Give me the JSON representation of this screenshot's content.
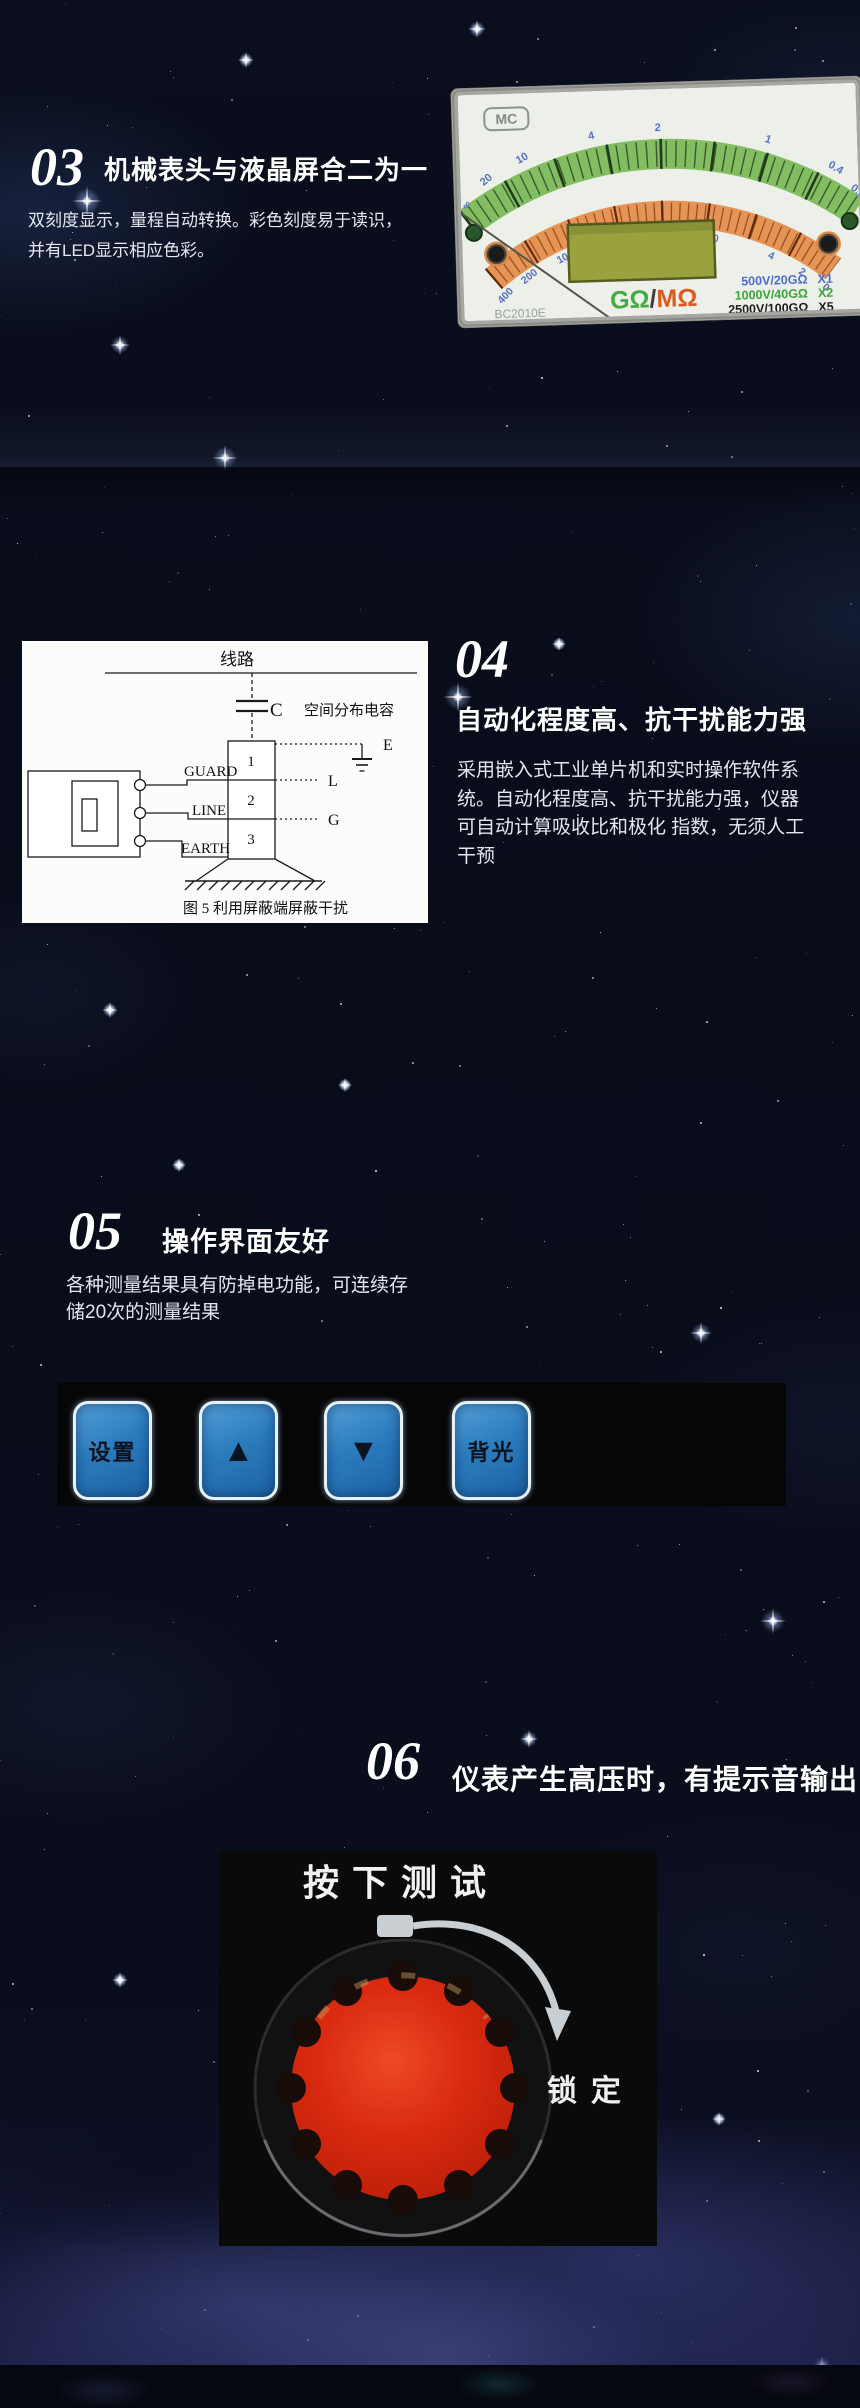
{
  "section03": {
    "number": "03",
    "title": "机械表头与液晶屏合二为一",
    "body": "双刻度显示，量程自动转换。彩色刻度易于读识，\n并有LED显示相应色彩。"
  },
  "meter": {
    "logo": "MC",
    "model": "BC2010E",
    "unit_green": "GΩ",
    "unit_divider": "/",
    "unit_orange": "MΩ",
    "outer_scale": [
      "∞",
      "20",
      "10",
      "4",
      "2",
      "1",
      "0.4",
      "0.2"
    ],
    "inner_scale": [
      "400",
      "200",
      "100",
      "40",
      "20",
      "10",
      "4",
      "2",
      "0"
    ],
    "ranges": [
      {
        "label": "500V/20GΩ",
        "mult": "X1",
        "color": "#4a6fd0"
      },
      {
        "label": "1000V/40GΩ",
        "mult": "X2",
        "color": "#3aa53a"
      },
      {
        "label": "2500V/100GΩ",
        "mult": "X5",
        "color": "#1c1c1c"
      },
      {
        "label": "5000V/200GΩ",
        "mult": "X10",
        "color": "#cc8f9c"
      }
    ],
    "colors": {
      "green_arc": "#83bd62",
      "orange_arc": "#e69455"
    }
  },
  "section04": {
    "number": "04",
    "title": "自动化程度高、抗干扰能力强",
    "body": "采用嵌入式工业单片机和实时操作软件系\n统。自动化程度高、抗干扰能力强，仪器\n可自动计算吸收比和极化 指数，无须人工\n干预"
  },
  "diagram": {
    "top_label": "线路",
    "cap_symbol": "C",
    "cap_label": "空间分布电容",
    "terminal_labels": [
      "GUARD",
      "LINE",
      "EARTH"
    ],
    "cell_labels": [
      "1",
      "2",
      "3"
    ],
    "node_labels": [
      "E",
      "L",
      "G"
    ],
    "caption": "图 5   利用屏蔽端屏蔽干扰"
  },
  "section05": {
    "number": "05",
    "title": "操作界面友好",
    "body": "各种测量结果具有防掉电功能，可连续存\n储20次的测量结果"
  },
  "keypad": {
    "button_color": "#2e7fc2",
    "buttons": [
      {
        "label": "设置",
        "type": "text"
      },
      {
        "label": "▲",
        "type": "up-arrow"
      },
      {
        "label": "▼",
        "type": "down-arrow"
      },
      {
        "label": "背光",
        "type": "text"
      }
    ]
  },
  "section06": {
    "number": "06",
    "title": "仪表产生高压时，有提示音输出"
  },
  "knob": {
    "press_label": "按下测试",
    "lock_label": "锁定",
    "knob_color": "#d6270f"
  }
}
